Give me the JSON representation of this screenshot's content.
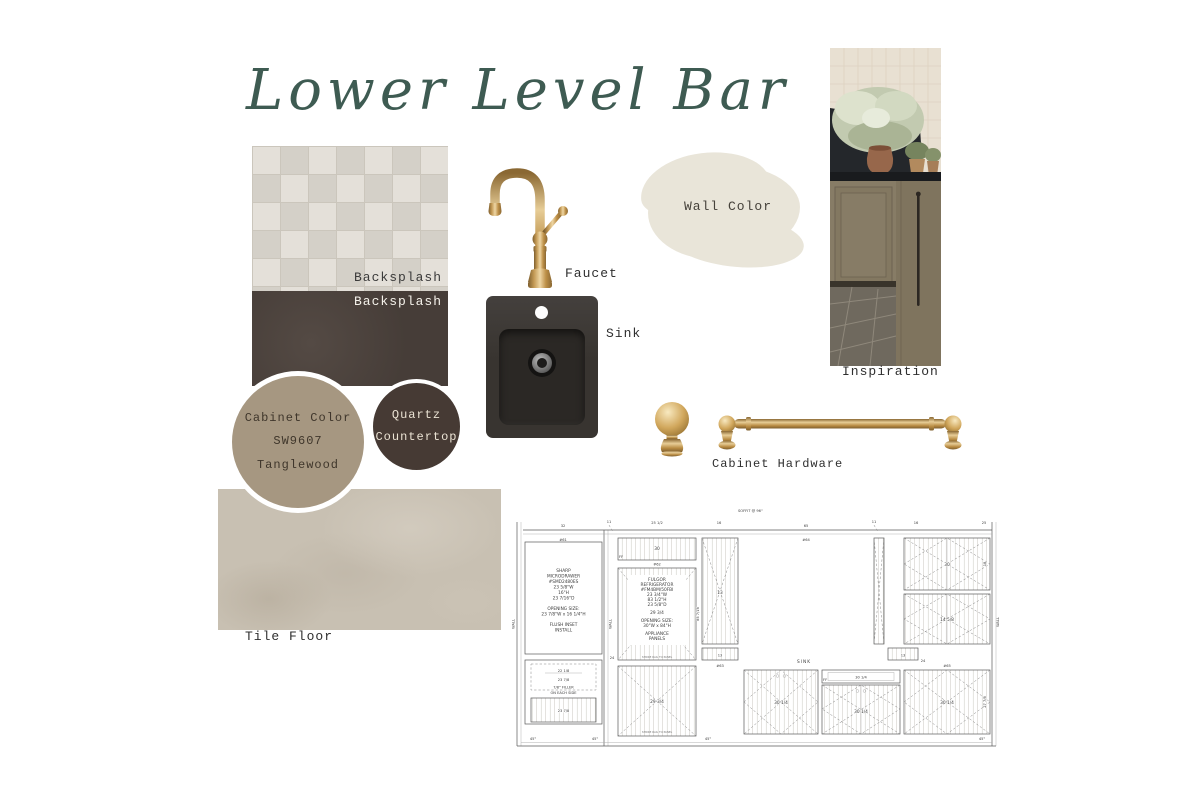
{
  "title": "Lower Level Bar",
  "labels": {
    "backsplash_top": "Backsplash",
    "backsplash_bottom": "Backsplash",
    "faucet": "Faucet",
    "sink": "Sink",
    "wall_color": "Wall Color",
    "inspiration": "Inspiration",
    "cabinet_hardware": "Cabinet Hardware",
    "tile_floor": "Tile Floor"
  },
  "swatches": {
    "cabinet_color": {
      "line1": "Cabinet Color",
      "line2": "SW9607",
      "line3": "Tanglewood",
      "hex": "#a69781"
    },
    "quartz": {
      "line1": "Quartz",
      "line2": "Countertop",
      "hex": "#463a34"
    },
    "wall_color_hex": "#e9e5d9",
    "backsplash_tile_hex": "#e4e0d9",
    "backsplash_dark_hex": "#463d38",
    "tile_floor_hex": "#c8c0b2",
    "brass_hex": "#c49a55",
    "title_hex": "#3e5b52"
  },
  "drawing": {
    "soffit": "SOFFIT @ 96\"",
    "top_dims": [
      "32",
      "11",
      "25 1/2",
      "16",
      "65",
      "11",
      "16",
      "25"
    ],
    "units": [
      "#61",
      "#62",
      "#63",
      "#64",
      "#65"
    ],
    "sharp": [
      "SHARP",
      "MICRODRAWER",
      "#SMD2480ES",
      "23 5/8\"W",
      "16\"H",
      "23 7/16\"D",
      "OPENING SIZE:",
      "23 7/8\"W x 16 1/4\"H",
      "FLUSH INSET",
      "INSTALL"
    ],
    "fridge": [
      "FULGOR",
      "REFRIGERATOR",
      "#FM4BM/50FBI",
      "23 3/4\"W",
      "83 1/2\"H",
      "23 5/8\"D",
      "29 3/4",
      "OPENING SIZE:",
      "30\"W x 84\"H",
      "APPLIANCE",
      "PANELS"
    ],
    "sink": "SINK",
    "wall": "WALL",
    "ff": "FF",
    "deg45": "45°",
    "dim_24": "24",
    "dim_30": "30",
    "dim_13": "13",
    "dim_29": "29 3/4",
    "dim_30q": "30 1/4",
    "dim_22": "22 1/8",
    "dim_23": "23 7/8",
    "filler_1": "7/8\" FILLER",
    "filler_2": "ON EACH SIDE",
    "strike": "STRIKE RAIL TO PANEL",
    "dim_85": "85 7/16",
    "dim_18": "18",
    "dim_14": "14 5/8",
    "dim_27": "27 7/8"
  }
}
